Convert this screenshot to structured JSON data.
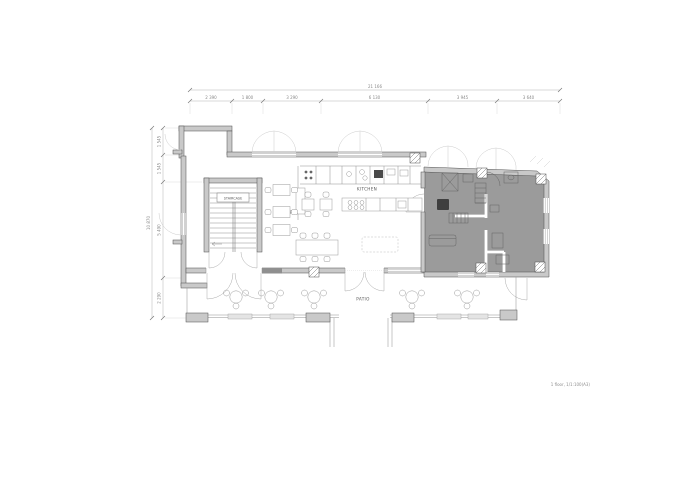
{
  "plan": {
    "note": "1 floor, 1/1:100(A3)",
    "rooms": {
      "staircase": "STAIRCASE",
      "kitchen": "KITCHEN",
      "cafe": "CAFE1",
      "patio": "PATIO"
    },
    "dimensions": {
      "top": {
        "total": "21 166",
        "segments": [
          "2 390",
          "1 800",
          "3 290",
          "6 130",
          "3 945",
          "3 640"
        ]
      },
      "left": {
        "total": "10 870",
        "segments": [
          "1 545",
          "1 545",
          "5 490",
          "2 290"
        ]
      }
    },
    "colors": {
      "wall": "#c9c9c9",
      "wall_edge": "#4f4f4f",
      "shaded_zone": "#9b9b9b",
      "dim_line": "#b4b4b4",
      "dim_text": "#8a8a8a"
    }
  }
}
